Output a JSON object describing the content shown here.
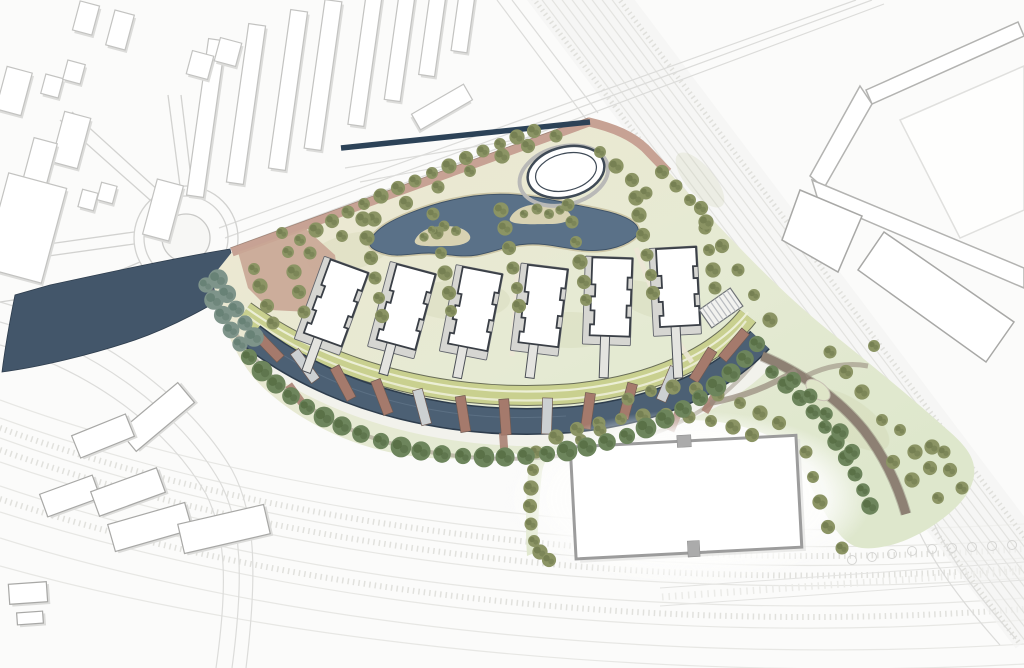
{
  "meta": {
    "drawing_type": "architectural-masterplan-site-plan",
    "visible_text": "none"
  },
  "palette": {
    "background": "#fbfbfa",
    "context_fill": "#ffffff",
    "context_stroke": "#c3c3c1",
    "context_shadow": "#dcdcda",
    "road_line": "#dcdcda",
    "rail_line": "#e3e3e0",
    "water_west": "#43566a",
    "pond": "#5a7188",
    "pond_edge": "#3e5165",
    "sand": "#cdc6a6",
    "canal": "#4c6074",
    "canal_edge": "#2e3d4d",
    "navy_strip": "#2c4257",
    "salmon_path": "#c7a294",
    "plaza": "#c9a695",
    "lawn_light": "#ece8d2",
    "lawn_mid": "#e5ead3",
    "lawn_deep": "#dee7cc",
    "park_strip": "#c9d08f",
    "park_edge": "#5b5f4a",
    "park_light": "#eef0da",
    "promenade": "#f2f2ec",
    "shore_path": "#978e80",
    "pier_brown": "#a57a6c",
    "pier_light": "#ccd0d2",
    "road_brown": "#8d8073",
    "tree_olive": "#8b9464",
    "tree_olive_dark": "#6d784b",
    "tree_promenade": "#6d855c",
    "tree_promenade_dark": "#52683f",
    "tree_shore": "#7e948a",
    "tree_shore_dark": "#5f7a6e",
    "building_fill": "#ffffff",
    "building_stroke": "#3a3f46",
    "plinth": "#d6d6d2",
    "stem": "#e4e4e0",
    "warehouse_stroke": "#9c9c9c",
    "notch": "#ababab",
    "pavilion_ring": "#b9b9b7",
    "pavilion_stroke": "#3f4a56"
  },
  "features": {
    "residential_buildings": {
      "count": 6,
      "width": 40,
      "height": 78,
      "items": [
        {
          "cx": 336,
          "cy": 303,
          "rot": 20,
          "stem": 40
        },
        {
          "cx": 406,
          "cy": 307,
          "rot": 15,
          "stem": 36
        },
        {
          "cx": 475,
          "cy": 309,
          "rot": 11,
          "stem": 36
        },
        {
          "cx": 543,
          "cy": 306,
          "rot": 7,
          "stem": 38
        },
        {
          "cx": 611,
          "cy": 297,
          "rot": 2,
          "stem": 46
        },
        {
          "cx": 678,
          "cy": 287,
          "rot": -3,
          "stem": 56
        }
      ]
    },
    "canal_piers": [
      [
        268,
        346,
        -44,
        0
      ],
      [
        305,
        366,
        -36,
        1
      ],
      [
        343,
        383,
        -28,
        0
      ],
      [
        382,
        397,
        -21,
        0
      ],
      [
        422,
        407,
        -15,
        1
      ],
      [
        463,
        414,
        -9,
        0
      ],
      [
        505,
        417,
        -4,
        0
      ],
      [
        547,
        416,
        2,
        1
      ],
      [
        588,
        411,
        8,
        0
      ],
      [
        628,
        401,
        15,
        0
      ],
      [
        668,
        384,
        23,
        1
      ],
      [
        703,
        365,
        32,
        0
      ],
      [
        734,
        345,
        40,
        0
      ]
    ],
    "promenade_crossings": [
      [
        297,
        396,
        -36
      ],
      [
        504,
        447,
        -4
      ],
      [
        676,
        418,
        23
      ],
      [
        712,
        400,
        31
      ]
    ],
    "context_buildings_top": [
      [
        206,
        118,
        17,
        158,
        8
      ],
      [
        246,
        104,
        17,
        160,
        8
      ],
      [
        288,
        90,
        17,
        160,
        8
      ],
      [
        323,
        75,
        17,
        150,
        8
      ],
      [
        365,
        60,
        16,
        132,
        8
      ],
      [
        400,
        45,
        16,
        112,
        8
      ],
      [
        433,
        30,
        16,
        92,
        8
      ],
      [
        464,
        16,
        16,
        72,
        8
      ],
      [
        442,
        107,
        18,
        60,
        60
      ],
      [
        14,
        91,
        26,
        44,
        15
      ],
      [
        52,
        86,
        18,
        20,
        15
      ],
      [
        74,
        72,
        18,
        20,
        15
      ],
      [
        71,
        140,
        27,
        52,
        15
      ],
      [
        40,
        162,
        24,
        44,
        15
      ],
      [
        88,
        200,
        16,
        18,
        15
      ],
      [
        107,
        193,
        16,
        18,
        15
      ],
      [
        25,
        228,
        60,
        98,
        15
      ],
      [
        163,
        210,
        27,
        57,
        15
      ],
      [
        200,
        65,
        22,
        24,
        15
      ],
      [
        228,
        52,
        22,
        24,
        15
      ],
      [
        120,
        30,
        20,
        36,
        15
      ],
      [
        86,
        18,
        20,
        30,
        15
      ]
    ],
    "context_buildings_bottom_left": [
      [
        157,
        417,
        76,
        26,
        -40
      ],
      [
        103,
        436,
        58,
        24,
        -22
      ],
      [
        70,
        496,
        56,
        24,
        -20
      ],
      [
        128,
        492,
        70,
        26,
        -20
      ],
      [
        150,
        527,
        80,
        28,
        -16
      ],
      [
        224,
        529,
        88,
        30,
        -13
      ],
      [
        28,
        593,
        38,
        20,
        -4
      ],
      [
        30,
        618,
        26,
        12,
        -4
      ]
    ],
    "trees_lawn": [
      [
        300,
        240
      ],
      [
        316,
        230
      ],
      [
        332,
        221
      ],
      [
        348,
        212
      ],
      [
        364,
        204
      ],
      [
        381,
        196
      ],
      [
        398,
        188
      ],
      [
        415,
        181
      ],
      [
        432,
        173
      ],
      [
        449,
        166
      ],
      [
        466,
        158
      ],
      [
        483,
        151
      ],
      [
        500,
        144
      ],
      [
        517,
        137
      ],
      [
        534,
        131
      ],
      [
        310,
        253
      ],
      [
        342,
        236
      ],
      [
        374,
        219
      ],
      [
        406,
        203
      ],
      [
        438,
        187
      ],
      [
        470,
        171
      ],
      [
        502,
        156
      ],
      [
        528,
        146
      ],
      [
        556,
        136
      ],
      [
        600,
        152
      ],
      [
        616,
        166
      ],
      [
        632,
        180
      ],
      [
        646,
        193
      ],
      [
        288,
        252
      ],
      [
        294,
        272
      ],
      [
        299,
        292
      ],
      [
        304,
        312
      ],
      [
        282,
        233
      ],
      [
        260,
        286
      ],
      [
        267,
        306
      ],
      [
        273,
        323
      ],
      [
        254,
        269
      ],
      [
        367,
        238
      ],
      [
        371,
        258
      ],
      [
        375,
        278
      ],
      [
        379,
        298
      ],
      [
        363,
        219
      ],
      [
        382,
        316
      ],
      [
        437,
        233
      ],
      [
        441,
        253
      ],
      [
        445,
        273
      ],
      [
        449,
        293
      ],
      [
        433,
        214
      ],
      [
        451,
        311
      ],
      [
        505,
        228
      ],
      [
        509,
        248
      ],
      [
        513,
        268
      ],
      [
        517,
        288
      ],
      [
        501,
        210
      ],
      [
        519,
        306
      ],
      [
        572,
        222
      ],
      [
        576,
        242
      ],
      [
        580,
        262
      ],
      [
        584,
        282
      ],
      [
        568,
        205
      ],
      [
        586,
        300
      ],
      [
        639,
        215
      ],
      [
        643,
        235
      ],
      [
        647,
        255
      ],
      [
        651,
        275
      ],
      [
        636,
        198
      ],
      [
        653,
        293
      ],
      [
        705,
        228
      ],
      [
        709,
        250
      ],
      [
        713,
        270
      ],
      [
        701,
        208
      ],
      [
        715,
        288
      ],
      [
        690,
        200
      ],
      [
        706,
        222
      ],
      [
        722,
        246
      ],
      [
        738,
        270
      ],
      [
        754,
        295
      ],
      [
        770,
        320
      ],
      [
        662,
        172
      ],
      [
        676,
        186
      ],
      [
        900,
        430
      ],
      [
        915,
        452
      ],
      [
        930,
        468
      ],
      [
        944,
        452
      ],
      [
        882,
        420
      ],
      [
        862,
        392
      ],
      [
        846,
        372
      ],
      [
        830,
        352
      ],
      [
        874,
        346
      ],
      [
        932,
        447
      ],
      [
        950,
        470
      ],
      [
        962,
        488
      ],
      [
        938,
        498
      ],
      [
        912,
        480
      ],
      [
        893,
        462
      ],
      [
        536,
        452
      ],
      [
        533,
        470
      ],
      [
        531,
        488
      ],
      [
        530,
        506
      ],
      [
        531,
        524
      ],
      [
        534,
        541
      ],
      [
        556,
        437
      ],
      [
        577,
        429
      ],
      [
        599,
        423
      ],
      [
        621,
        419
      ],
      [
        643,
        416
      ],
      [
        666,
        415
      ],
      [
        689,
        417
      ],
      [
        711,
        421
      ],
      [
        733,
        427
      ],
      [
        752,
        435
      ],
      [
        628,
        399
      ],
      [
        651,
        391
      ],
      [
        673,
        387
      ],
      [
        696,
        389
      ],
      [
        718,
        395
      ],
      [
        740,
        403
      ],
      [
        760,
        413
      ],
      [
        779,
        423
      ],
      [
        600,
        430
      ],
      [
        581,
        440
      ],
      [
        540,
        552
      ],
      [
        549,
        560
      ],
      [
        806,
        452
      ],
      [
        813,
        477
      ],
      [
        820,
        502
      ],
      [
        828,
        527
      ],
      [
        842,
        548
      ]
    ],
    "trees_island": [
      [
        432,
        230
      ],
      [
        444,
        226
      ],
      [
        456,
        231
      ],
      [
        424,
        237
      ],
      [
        524,
        214
      ],
      [
        537,
        209
      ],
      [
        549,
        214
      ],
      [
        560,
        210
      ]
    ],
    "trees_promenade": [
      [
        249,
        357
      ],
      [
        262,
        371
      ],
      [
        276,
        384
      ],
      [
        291,
        396
      ],
      [
        307,
        407
      ],
      [
        324,
        417
      ],
      [
        342,
        426
      ],
      [
        361,
        434
      ],
      [
        381,
        441
      ],
      [
        401,
        447
      ],
      [
        421,
        451
      ],
      [
        442,
        454
      ],
      [
        463,
        456
      ],
      [
        484,
        457
      ],
      [
        505,
        457
      ],
      [
        526,
        456
      ],
      [
        547,
        454
      ],
      [
        567,
        451
      ],
      [
        587,
        447
      ],
      [
        607,
        442
      ],
      [
        627,
        436
      ],
      [
        646,
        428
      ],
      [
        665,
        419
      ],
      [
        683,
        409
      ],
      [
        700,
        398
      ],
      [
        716,
        386
      ],
      [
        731,
        373
      ],
      [
        745,
        359
      ],
      [
        757,
        344
      ]
    ],
    "trees_shore": [
      [
        206,
        285
      ],
      [
        214,
        300
      ],
      [
        223,
        315
      ],
      [
        231,
        330
      ],
      [
        240,
        344
      ],
      [
        218,
        279
      ],
      [
        227,
        294
      ],
      [
        236,
        309
      ],
      [
        245,
        323
      ],
      [
        254,
        337
      ]
    ],
    "trees_road": [
      [
        772,
        372
      ],
      [
        786,
        385
      ],
      [
        800,
        398
      ],
      [
        813,
        412
      ],
      [
        825,
        427
      ],
      [
        836,
        442
      ],
      [
        846,
        458
      ],
      [
        855,
        474
      ],
      [
        863,
        490
      ],
      [
        870,
        506
      ],
      [
        793,
        380
      ],
      [
        810,
        396
      ],
      [
        826,
        414
      ],
      [
        840,
        432
      ],
      [
        852,
        452
      ]
    ],
    "parking_tree_markers": [
      [
        852,
        560
      ],
      [
        872,
        557
      ],
      [
        892,
        554
      ],
      [
        912,
        551
      ],
      [
        932,
        549
      ],
      [
        952,
        548
      ],
      [
        972,
        547
      ],
      [
        992,
        546
      ],
      [
        1012,
        545
      ]
    ]
  }
}
